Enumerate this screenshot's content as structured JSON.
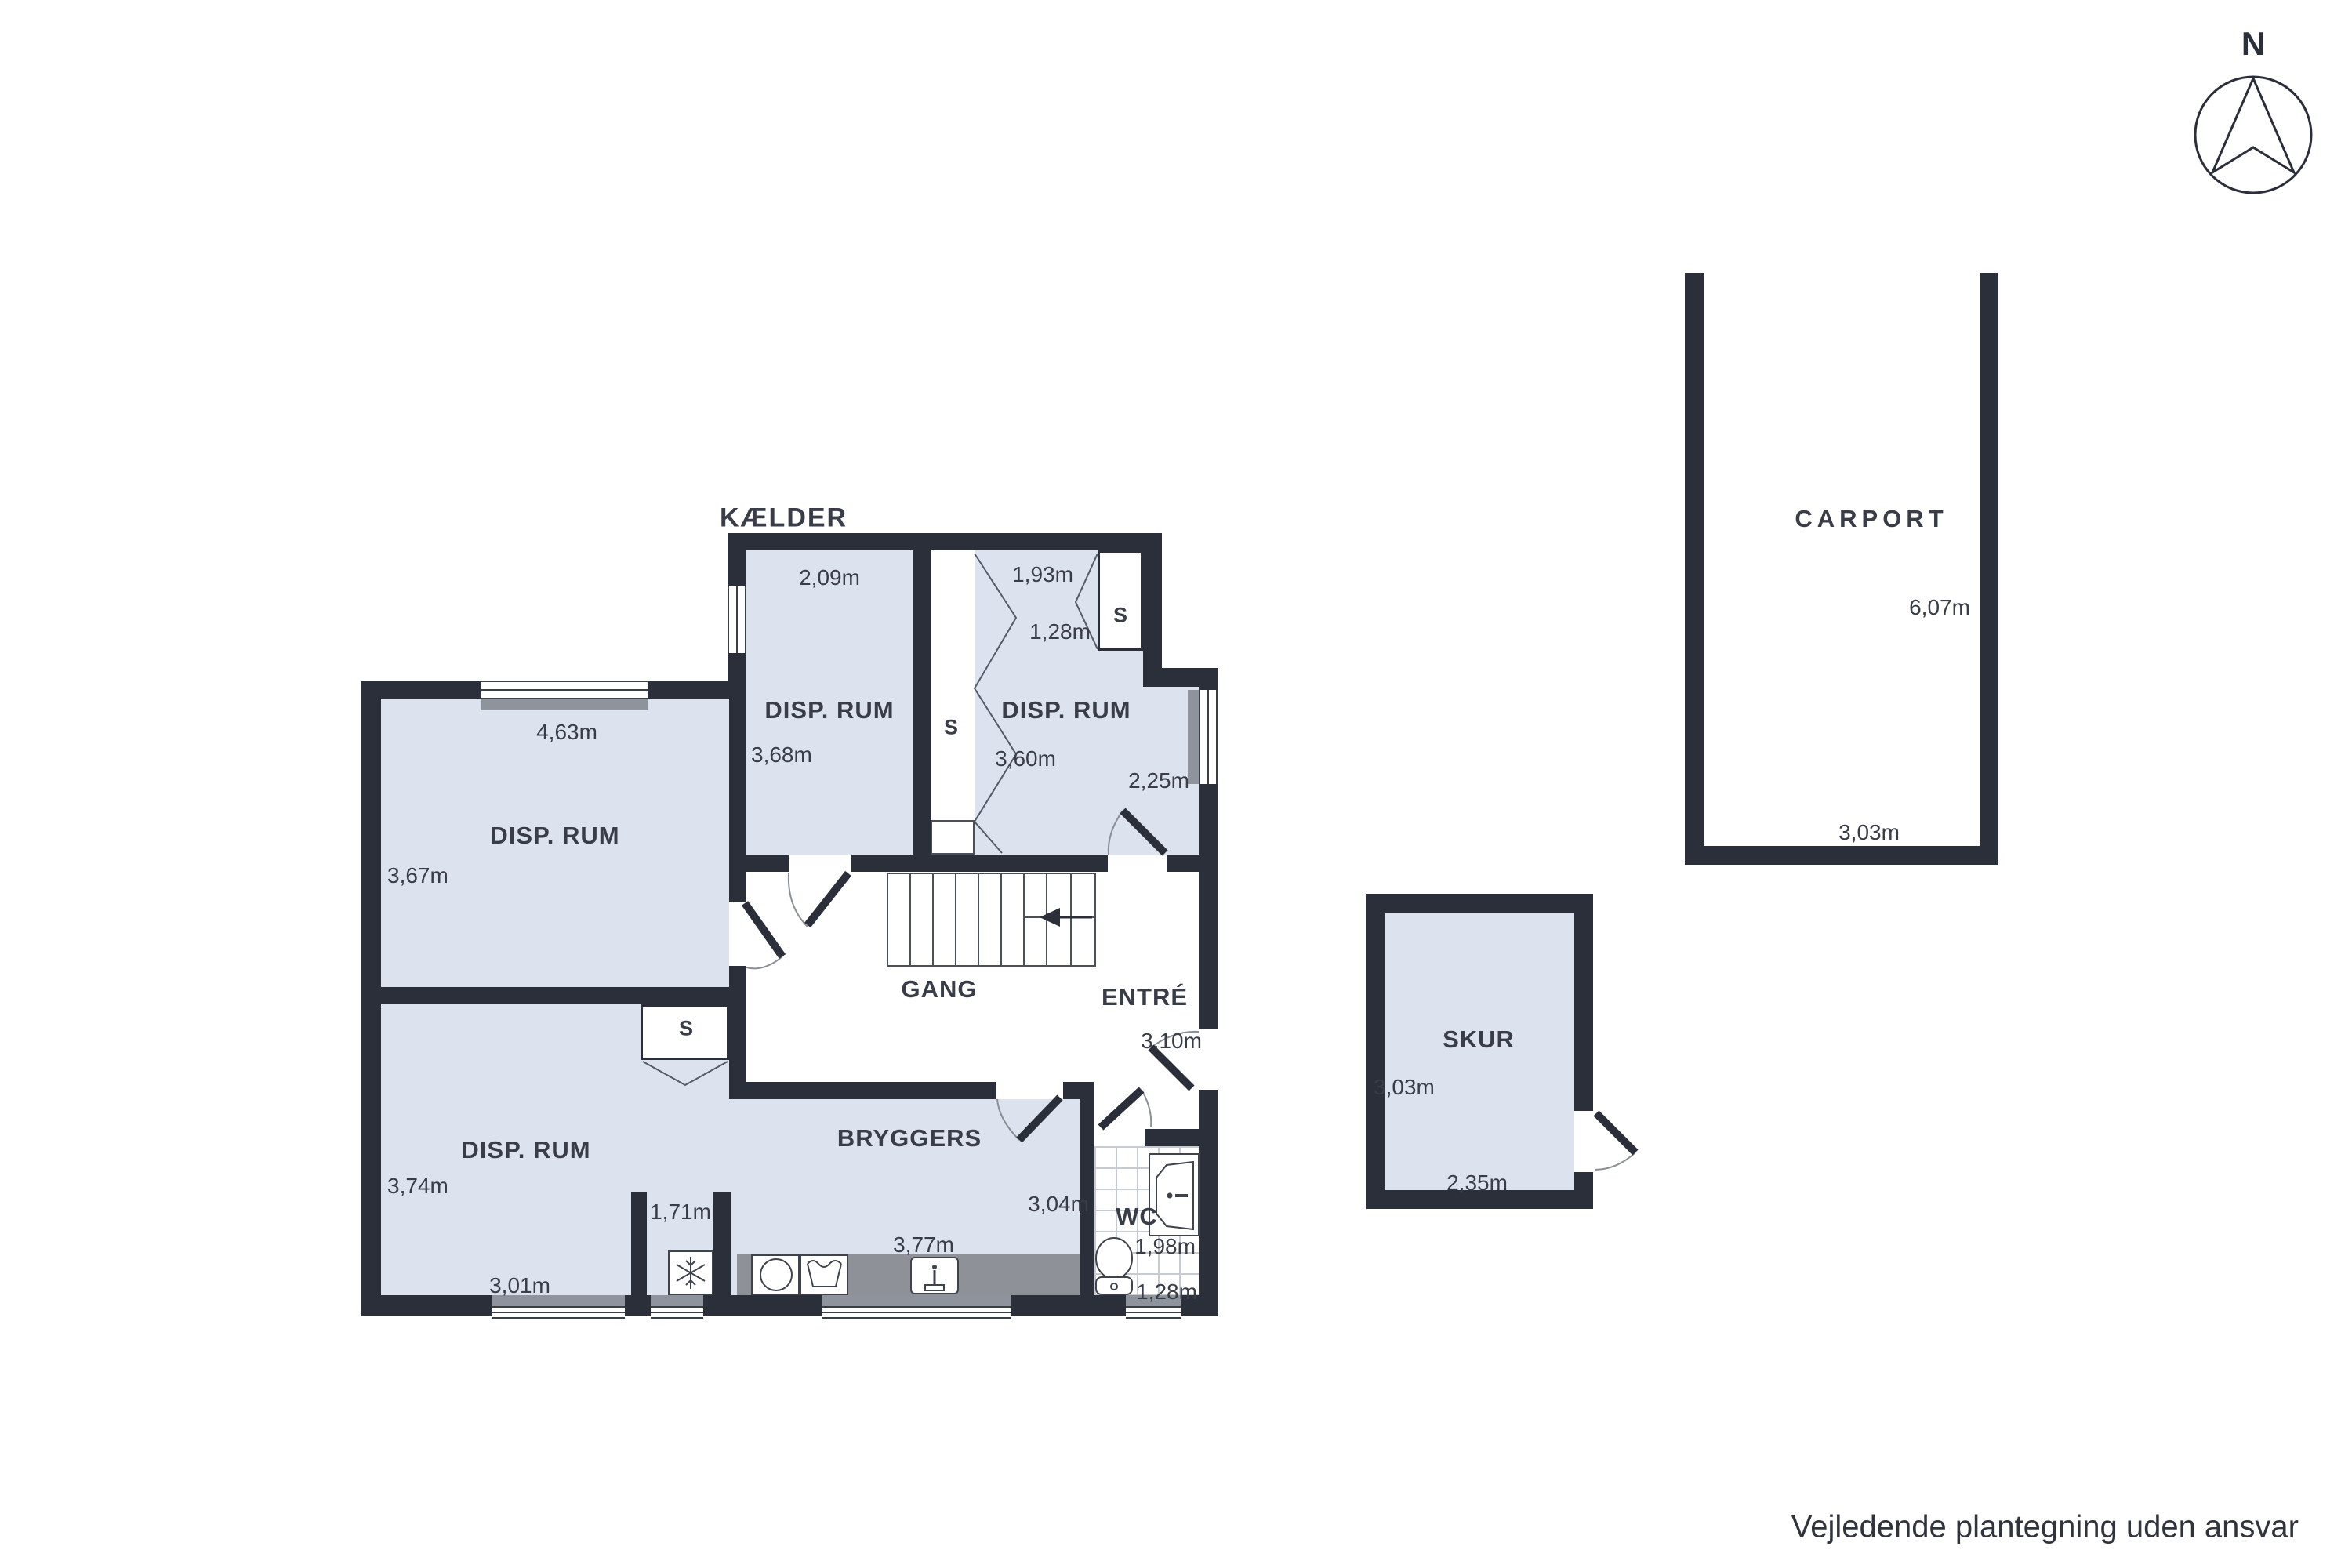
{
  "plan": {
    "title": "KÆLDER",
    "compass": "N",
    "disclaimer": "Vejledende plantegning uden ansvar"
  },
  "colors": {
    "wall": "#2b2f3a",
    "room_fill": "#dce3ee",
    "counter": "#8e9197",
    "text": "#383d47"
  },
  "rooms": [
    {
      "id": "disp-rum-nw",
      "name": "DISP. RUM",
      "dims": [
        "4,63m",
        "3,67m"
      ]
    },
    {
      "id": "disp-rum-n",
      "name": "DISP. RUM",
      "dims": [
        "2,09m",
        "3,68m"
      ]
    },
    {
      "id": "disp-rum-ne",
      "name": "DISP. RUM",
      "dims": [
        "1,93m",
        "1,28m",
        "3,60m",
        "2,25m"
      ]
    },
    {
      "id": "disp-rum-sw",
      "name": "DISP. RUM",
      "dims": [
        "3,74m",
        "3,01m"
      ]
    },
    {
      "id": "nook",
      "name": "",
      "dims": [
        "1,71m"
      ]
    },
    {
      "id": "gang",
      "name": "GANG",
      "dims": []
    },
    {
      "id": "entre",
      "name": "ENTRÉ",
      "dims": [
        "3,10m"
      ]
    },
    {
      "id": "bryggers",
      "name": "BRYGGERS",
      "dims": [
        "3,77m",
        "3,04m"
      ]
    },
    {
      "id": "wc",
      "name": "WC",
      "dims": [
        "1,98m",
        "1,28m"
      ]
    },
    {
      "id": "skur",
      "name": "SKUR",
      "dims": [
        "3,03m",
        "2,35m"
      ]
    },
    {
      "id": "carport",
      "name": "CARPORT",
      "dims": [
        "6,07m",
        "3,03m"
      ]
    }
  ],
  "closets": [
    {
      "label": "S"
    },
    {
      "label": "S"
    },
    {
      "label": "S"
    }
  ]
}
